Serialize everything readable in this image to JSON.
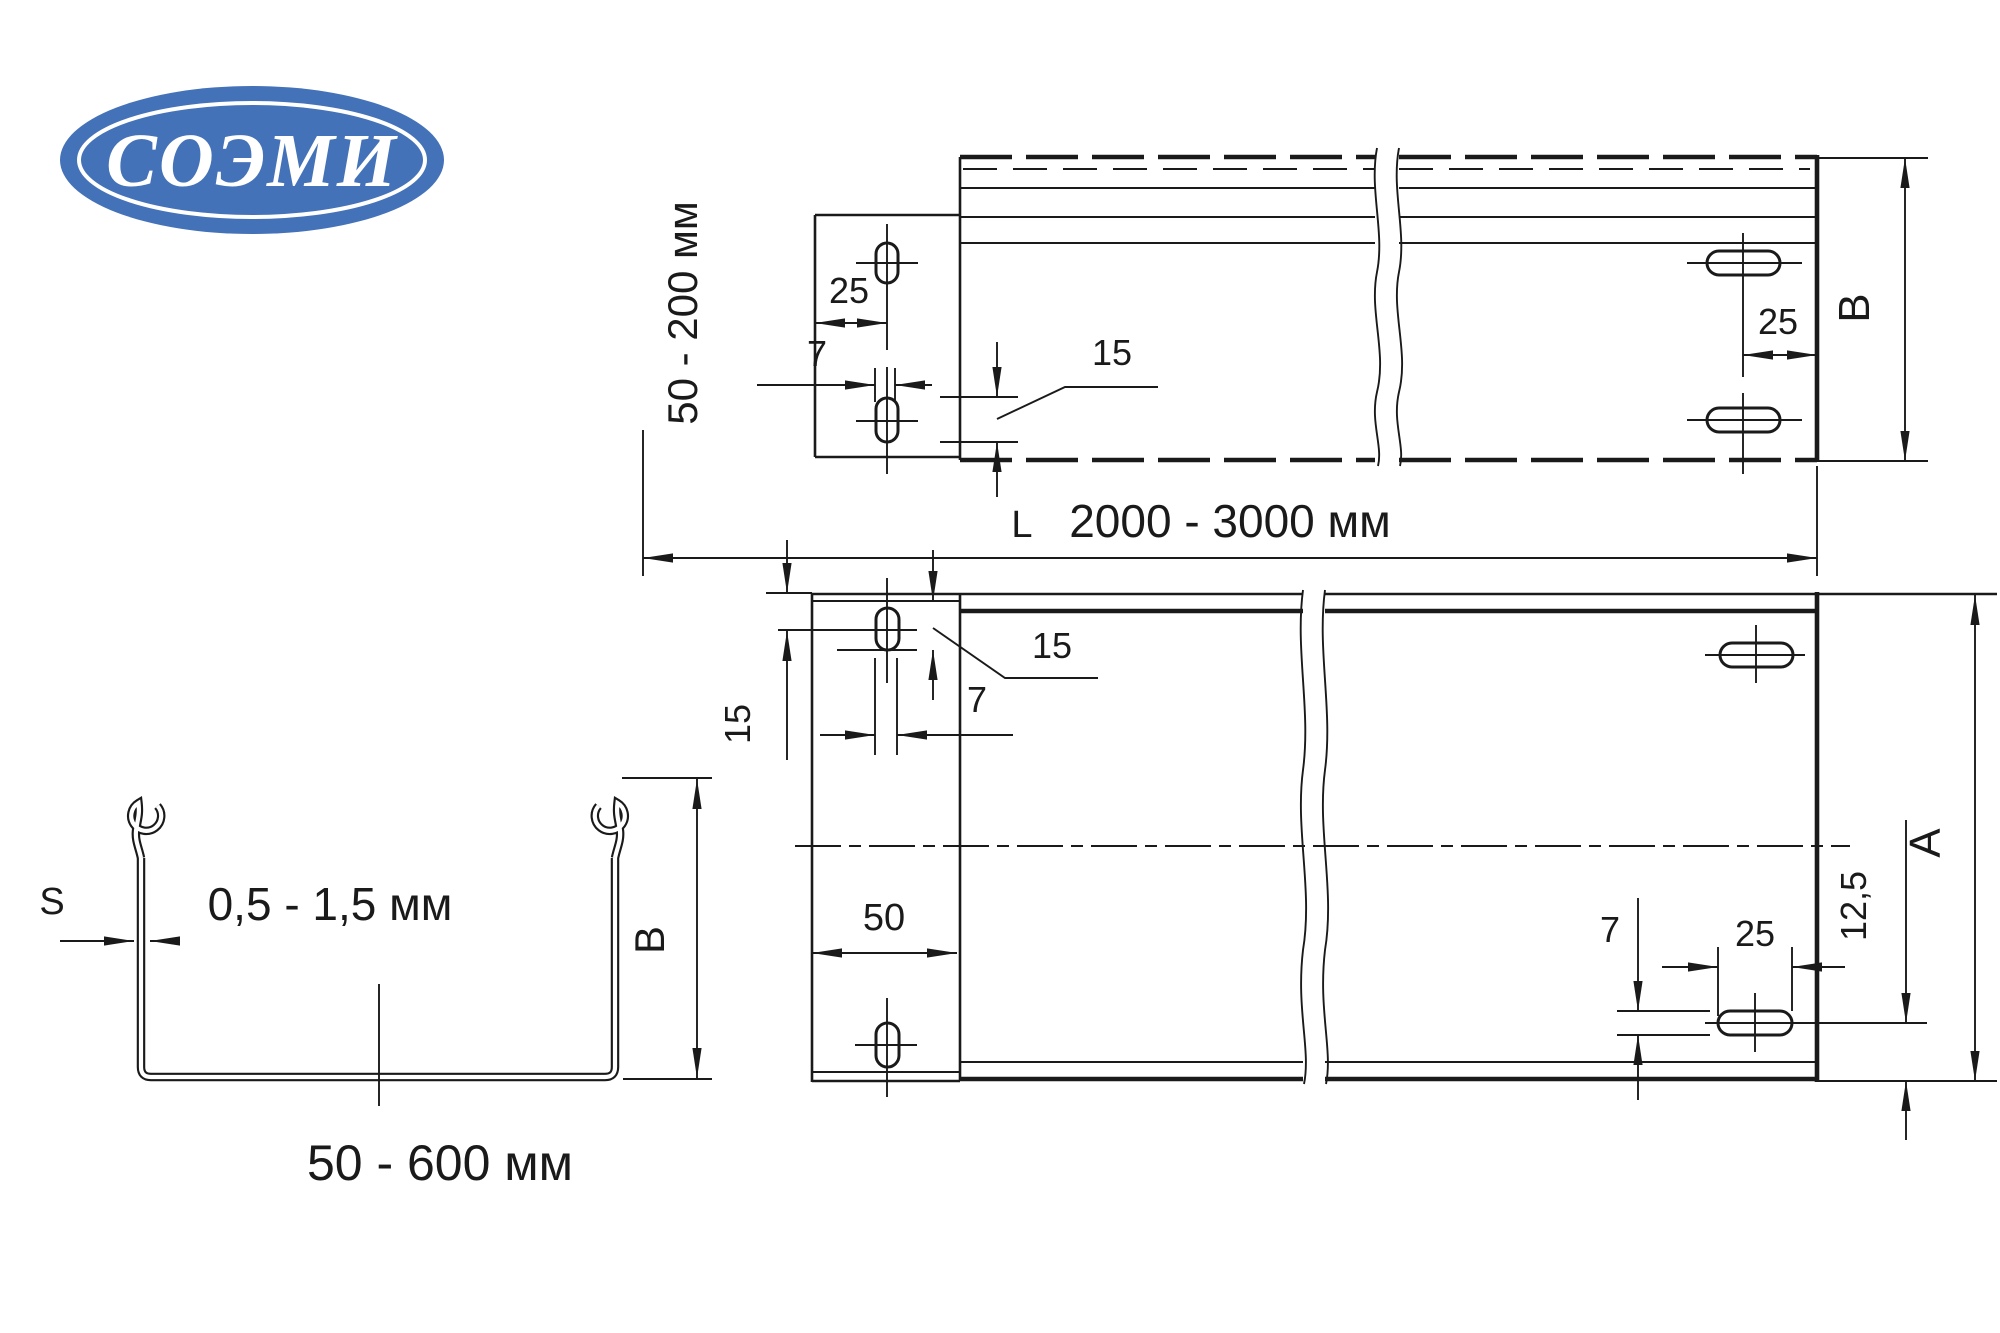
{
  "logo": {
    "text": "СОЭМИ",
    "fill": "#4472b8"
  },
  "side_view": {
    "height_range": "50 - 200 мм",
    "dim_left_25": "25",
    "dim_left_7": "7",
    "dim_slot_15": "15",
    "dim_right_25": "25",
    "dim_height": "B"
  },
  "length": {
    "symbol": "L",
    "range": "2000 - 3000 мм"
  },
  "plan_view": {
    "dim_left_15": "15",
    "dim_slot_15": "15",
    "dim_slot_7": "7",
    "dim_tab_50": "50",
    "dim_bottom_7": "7",
    "dim_bottom_25": "25",
    "dim_offset_12_5": "12,5",
    "dim_width": "A"
  },
  "cross_section": {
    "dim_thickness_symbol": "S",
    "thickness_range": "0,5 - 1,5 мм",
    "dim_height": "B",
    "width_range": "50 - 600 мм"
  }
}
